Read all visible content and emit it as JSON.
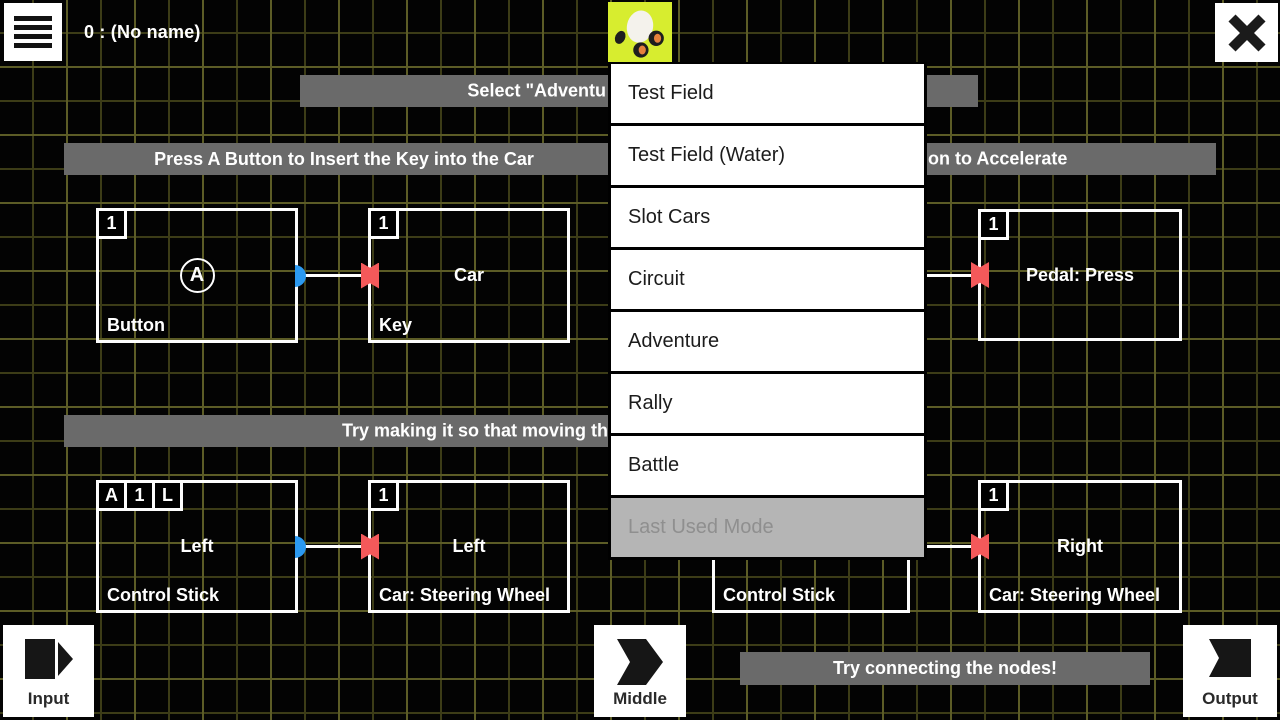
{
  "header": {
    "title": "0 : (No name)"
  },
  "mode_menu": {
    "items": [
      {
        "label": "Test Field",
        "enabled": true
      },
      {
        "label": "Test Field (Water)",
        "enabled": true
      },
      {
        "label": "Slot Cars",
        "enabled": true
      },
      {
        "label": "Circuit",
        "enabled": true
      },
      {
        "label": "Adventure",
        "enabled": true
      },
      {
        "label": "Rally",
        "enabled": true
      },
      {
        "label": "Battle",
        "enabled": true
      },
      {
        "label": "Last Used Mode",
        "enabled": false
      }
    ]
  },
  "banners": {
    "select_mode": {
      "text": "Select \"Adventu"
    },
    "insert_key": {
      "text": "Press A Button to Insert the Key into the Car"
    },
    "accelerate": {
      "text": "on to Accelerate"
    },
    "steering_hint": {
      "text": "Try making it so that moving th"
    },
    "connect_hint": {
      "text": "Try connecting the nodes!"
    }
  },
  "nodes": {
    "button": {
      "badges": [
        "1"
      ],
      "center_symbol": "A",
      "bottom": "Button"
    },
    "key": {
      "badges": [
        "1"
      ],
      "center": "Car",
      "bottom": "Key"
    },
    "pedal": {
      "badges": [
        "1"
      ],
      "center": "Pedal: Press",
      "bottom": ""
    },
    "control_stick_left": {
      "badges": [
        "A",
        "1",
        "L"
      ],
      "center": "Left",
      "bottom": "Control Stick"
    },
    "steering_left": {
      "badges": [
        "1"
      ],
      "center": "Left",
      "bottom": "Car: Steering Wheel"
    },
    "control_stick_middle": {
      "bottom": "Control Stick"
    },
    "steering_right": {
      "badges": [
        "1"
      ],
      "center": "Right",
      "bottom": "Car: Steering Wheel"
    }
  },
  "footer": {
    "input": {
      "label": "Input"
    },
    "middle": {
      "label": "Middle"
    },
    "output": {
      "label": "Output"
    }
  },
  "colors": {
    "accent": "#d7ed2f",
    "banner_bg": "#6a6a6a",
    "port_input": "#f4595a",
    "port_output": "#2b99f0",
    "grid_line": "#3c3c17",
    "grid_line_major": "#5c5c26",
    "menu_disabled_bg": "#b5b5b5",
    "menu_disabled_text": "#8f8f8f"
  }
}
